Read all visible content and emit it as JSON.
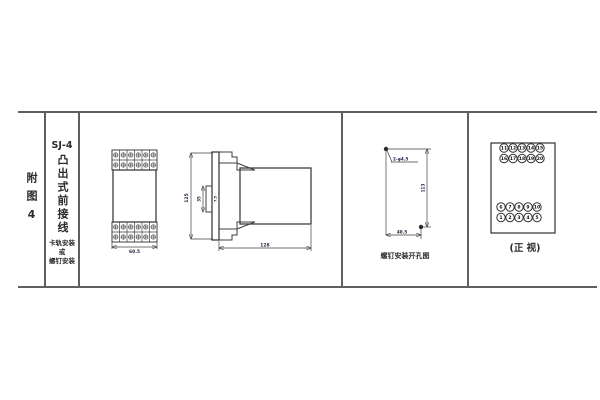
{
  "figure": {
    "index_label": "附图4",
    "model": "SJ-4",
    "title_vertical": "凸出式前接线",
    "mounting_note_lines": [
      "卡轨安装",
      "或",
      "螺钉安装"
    ]
  },
  "front_view": {
    "width_dim": "60.5"
  },
  "side_view": {
    "height_dim": "125",
    "rail_slot_dim": "35",
    "slot_depth_dim": "7.5",
    "depth_dim": "128"
  },
  "drill_view": {
    "holes_label": "2-φ4.5",
    "vertical_dim": "113",
    "horizontal_dim": "48.5",
    "caption": "螺钉安装开孔图"
  },
  "terminal_view": {
    "caption": "(正 视)",
    "top_group": [
      [
        "11",
        "12",
        "13",
        "14",
        "15"
      ],
      [
        "16",
        "17",
        "18",
        "19",
        "20"
      ]
    ],
    "bottom_group": [
      [
        "6",
        "7",
        "8",
        "9",
        "10"
      ],
      [
        "1",
        "2",
        "3",
        "4",
        "5"
      ]
    ]
  }
}
